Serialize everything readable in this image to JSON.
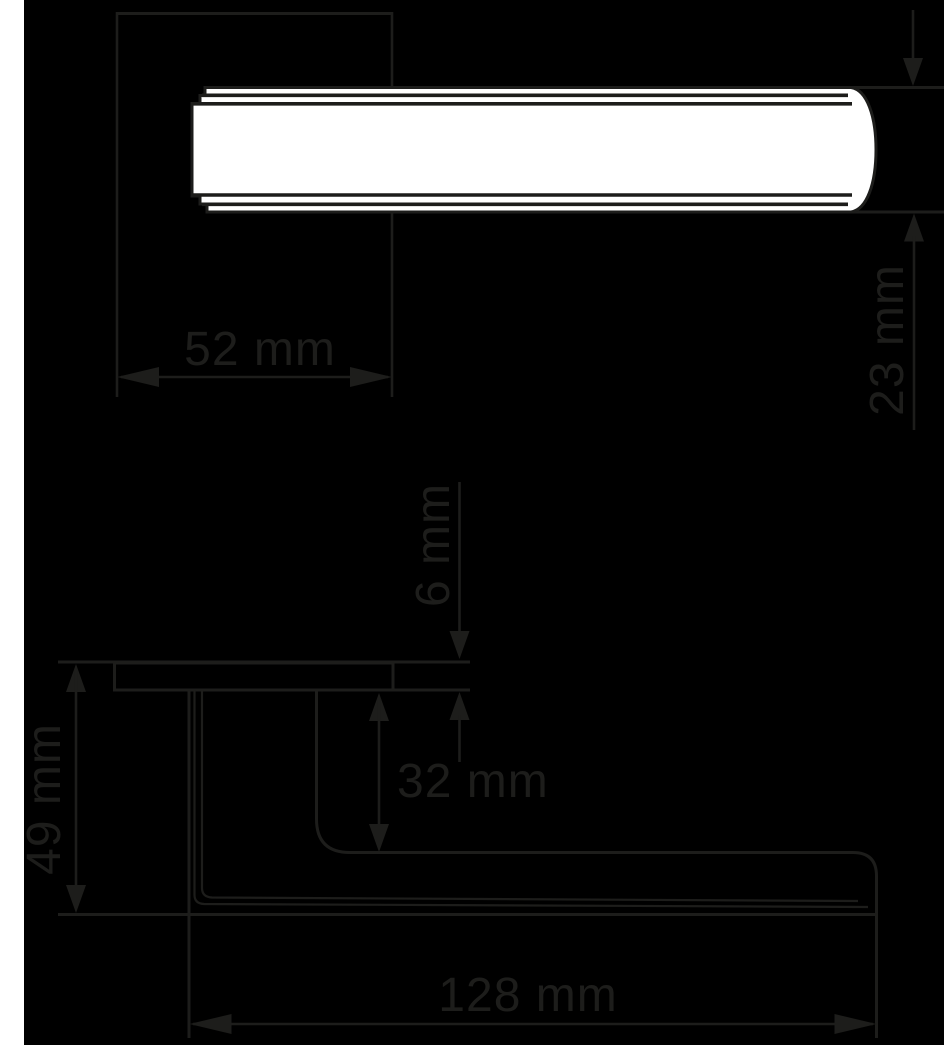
{
  "drawing": {
    "title": "door-handle-technical-drawing",
    "views": {
      "top_view": "handle top view",
      "side_view": "handle side view"
    },
    "colors": {
      "background": "#000000",
      "line": "#1d1d1b",
      "handle_fill": "#ffffff",
      "page_edge_strip": "#ffffff"
    },
    "dimensions": {
      "rose_width": "52 mm",
      "grip_thickness": "23 mm",
      "rose_height": "6 mm",
      "projection": "49 mm",
      "neck_clearance": "32 mm",
      "grip_length": "128 mm"
    }
  }
}
